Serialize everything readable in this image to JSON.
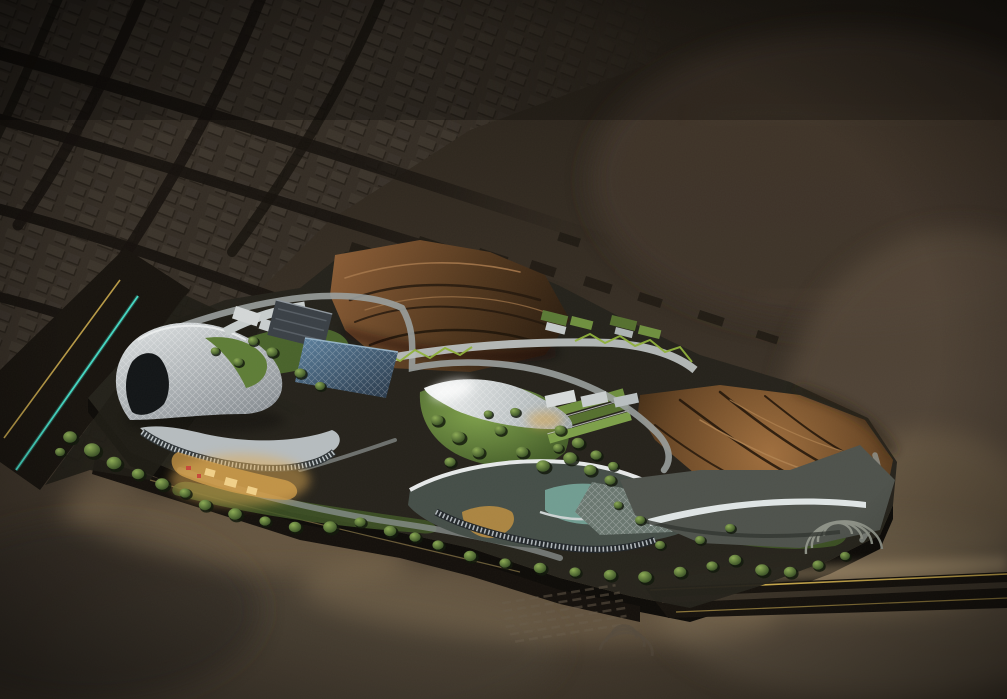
{
  "scene": {
    "name": "night-aerial-masterplan-render",
    "setting": "illuminated masterplan model in dark desert beside unlit city grid"
  },
  "palette": {
    "background_top": "#272119",
    "background_bottom": "#463c2f",
    "city_block": "#3b342b",
    "city_road": "#15110d",
    "site_ground": "#24221b",
    "rock_light": "#a06f3e",
    "rock_mid": "#6b4826",
    "rock_dark": "#271a0e",
    "canopy_white": "#f2f4f4",
    "structure_grey": "#9aa3a6",
    "glass_blue": "#5d82a0",
    "lawn_light": "#81a34d",
    "lawn_dark": "#3c5424",
    "tree_green": "#2c421d",
    "accent_teal": "#45d7c3",
    "accent_yellow": "#c9a94c",
    "warm_glow": "#e0ac55",
    "ground_glow": "#c2a478"
  }
}
